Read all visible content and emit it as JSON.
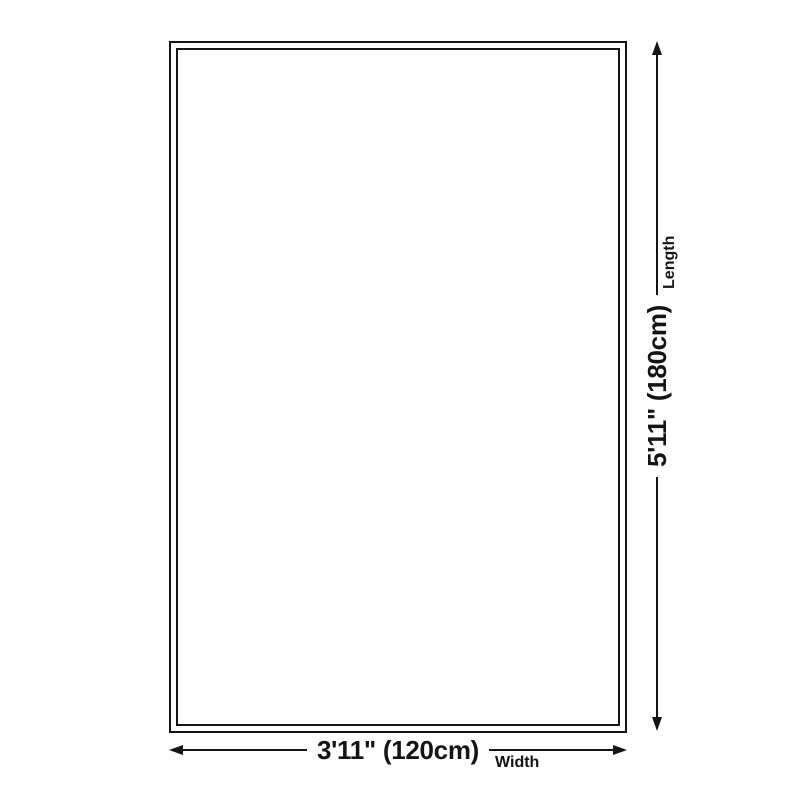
{
  "diagram": {
    "kind": "rug-size-diagram",
    "dimensions": {
      "width": {
        "value": "3'11\" (120cm)",
        "label": "Width"
      },
      "length": {
        "value": "5'11\" (180cm)",
        "label": "Length"
      }
    }
  },
  "colors": {
    "ink": "#141414",
    "background": "#ffffff"
  }
}
